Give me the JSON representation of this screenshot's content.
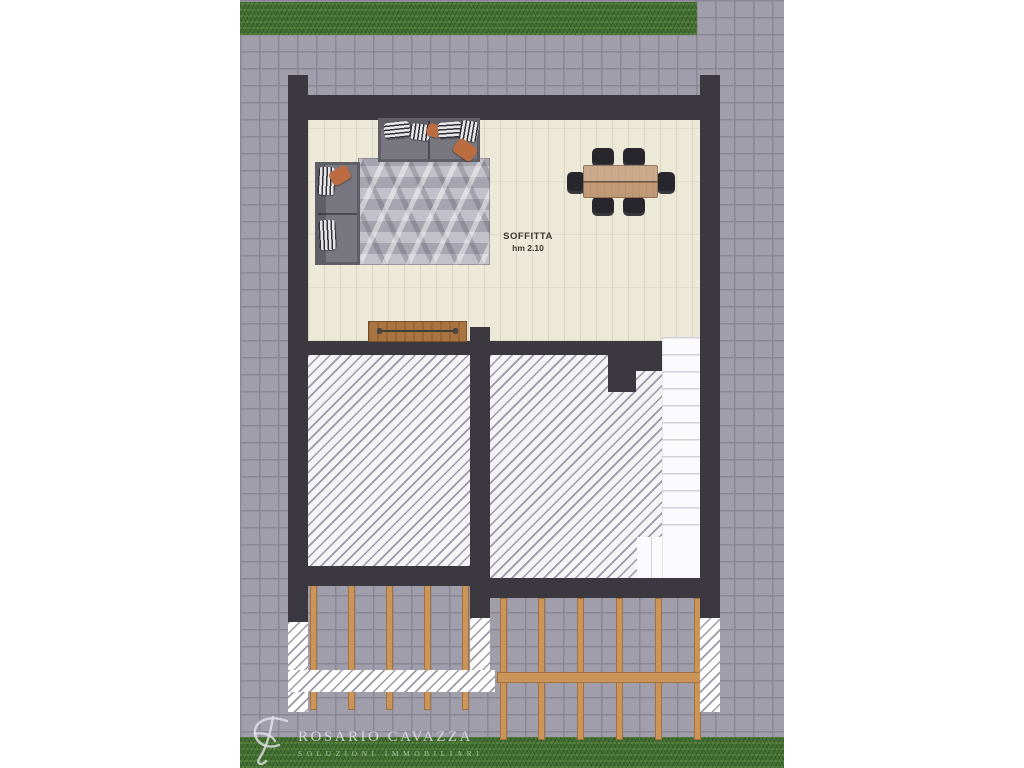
{
  "room": {
    "label": "SOFFITTA",
    "height_note": "hm 2.10"
  },
  "watermark": {
    "brand": "ROSARIO CAVAZZA",
    "tagline": "SOLUZIONI IMMOBILIARI"
  },
  "objects": [
    "corner-sofa",
    "geometric-rug",
    "dining-table",
    "dining-chairs",
    "sideboard",
    "staircase",
    "hatched-void-areas",
    "pergola-beams",
    "paved-courtyard",
    "lawn-strips",
    "brand-monogram"
  ],
  "colors": {
    "wall": "#3b3840",
    "paving": "#a19eab",
    "paving_joint": "#8a8794",
    "grass_dark": "#3e6b2c",
    "grass_light": "#4c7c38",
    "floor": "#ece9d9",
    "floor_line": "#d8d4c2",
    "hatch_bg": "#f4f3f6",
    "hatch_line": "#9b99a6",
    "stair_bg": "#fbfbfd",
    "stair_line": "#d2d1da",
    "rug_base": "#b5b3bd",
    "sofa_frame": "#5f5e66",
    "sofa_seat": "#78777f",
    "wood_table": "#c09a77",
    "wood_sideboard": "#aa7440",
    "wood_beam": "#cb9459",
    "chair": "#27262c",
    "pillow_orange": "#bc6c41",
    "pillow_stripe_dark": "#323138",
    "pillow_stripe_light": "#e6e6e8",
    "label_ink": "#3a382e",
    "watermark_ink": "#dcdbe0"
  }
}
